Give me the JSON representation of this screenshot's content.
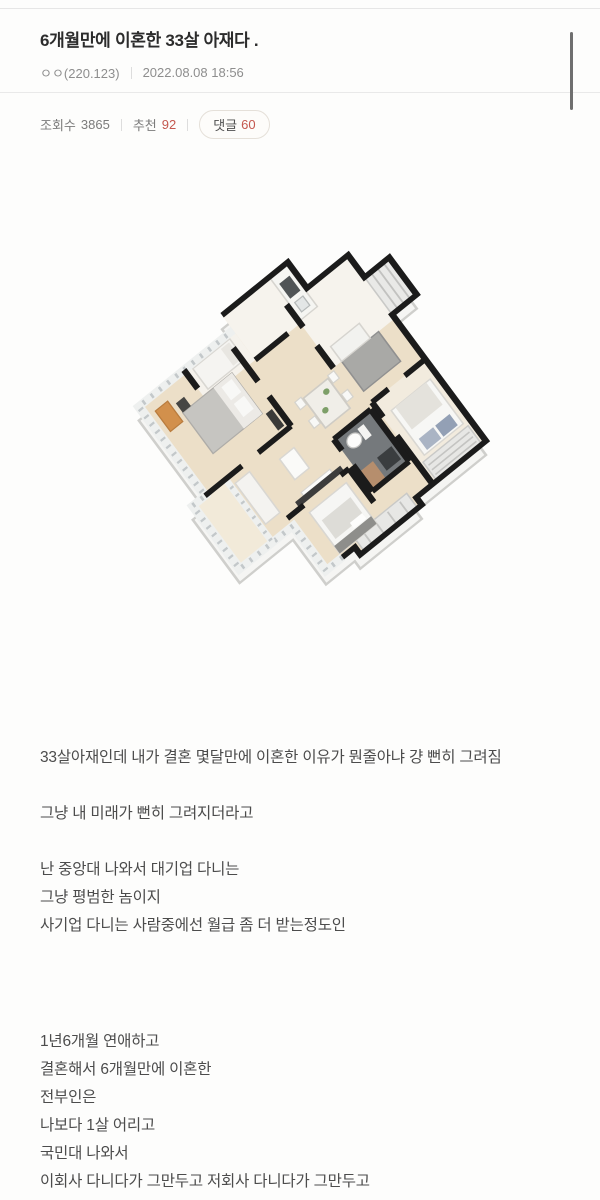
{
  "header": {
    "title": "6개월만에 이혼한 33살 아재다 .",
    "author": "ㅇㅇ(220.123)",
    "timestamp": "2022.08.08 18:56"
  },
  "stats": {
    "views_label": "조회수",
    "views_count": "3865",
    "upvote_label": "추천",
    "upvote_count": "92",
    "comment_label": "댓글",
    "comment_count": "60"
  },
  "image": {
    "description": "3D isometric apartment floor plan render"
  },
  "body": {
    "paragraphs": [
      [
        "33살아재인데 내가 결혼 몇달만에 이혼한 이유가 뭔줄아냐 걍 뻔히 그려짐"
      ],
      [
        "그냥 내 미래가 뻔히 그려지더라고"
      ],
      [
        "난 중앙대 나와서 대기업 다니는",
        "그냥 평범한 놈이지",
        "사기업 다니는 사람중에선 월급 좀 더 받는정도인"
      ],
      [
        "1년6개월 연애하고",
        "결혼해서 6개월만에 이혼한",
        "전부인은",
        "나보다 1살 어리고",
        "국민대 나와서",
        "이회사 다니다가 그만두고 저회사 다니다가 그만두고"
      ]
    ]
  },
  "palette": {
    "accent_red": "#c4574e",
    "wall_black": "#1b1b1b",
    "floor_beige": "#ecdfc8",
    "window_gray": "#c3c8ca",
    "slab_white": "#f5f5f3"
  }
}
